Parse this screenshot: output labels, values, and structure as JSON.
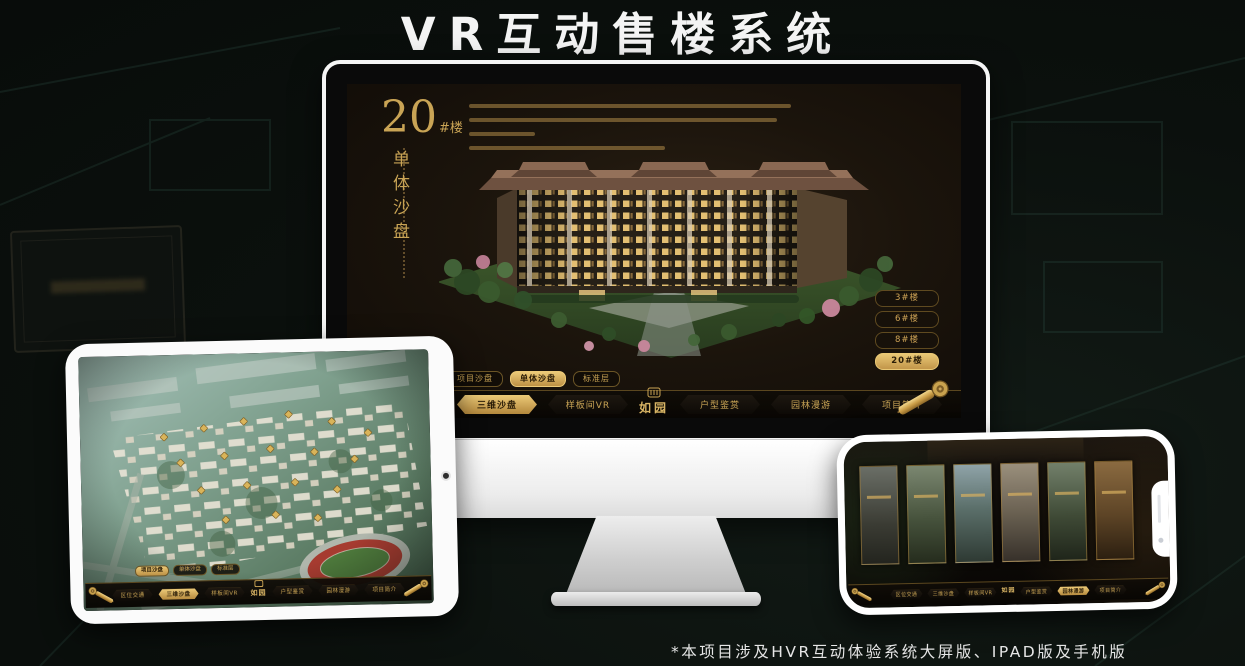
{
  "page": {
    "title": "VR互动售楼系统",
    "footnote": "*本项目涉及HVR互动体验系统大屏版、IPAD版及手机版"
  },
  "colors": {
    "gold": "#c9a455",
    "gold_bright": "#ecca78",
    "screen_bg": "#1b140c",
    "nav_bg": "#0d0a06",
    "canvas_bg": "#0b100d"
  },
  "monitor": {
    "building_no": "20",
    "building_no_suffix": "#楼",
    "building_subtitle": "单体沙盘",
    "floor_buttons": [
      {
        "label": "3#楼",
        "active": false
      },
      {
        "label": "6#楼",
        "active": false
      },
      {
        "label": "8#楼",
        "active": false
      },
      {
        "label": "20#楼",
        "active": true
      }
    ],
    "view_tabs": [
      {
        "label": "项目沙盘",
        "active": false
      },
      {
        "label": "单体沙盘",
        "active": true
      },
      {
        "label": "标准层",
        "active": false
      }
    ]
  },
  "tablet": {
    "view_tabs": [
      {
        "label": "项目沙盘",
        "active": true
      },
      {
        "label": "单体沙盘",
        "active": false
      },
      {
        "label": "标准层",
        "active": false
      }
    ],
    "scene": "aerial-masterplan-view"
  },
  "phone": {
    "gallery_panels": 6,
    "scene": "interior-gallery-view",
    "active_nav": "园林漫游"
  },
  "nav": {
    "logo": "如园",
    "monitor_active": "三维沙盘",
    "tablet_active": "三维沙盘",
    "items": [
      {
        "label": "区位交通"
      },
      {
        "label": "三维沙盘"
      },
      {
        "label": "样板间VR"
      },
      {
        "label": "户型鉴赏"
      },
      {
        "label": "园林漫游"
      },
      {
        "label": "项目简介"
      }
    ]
  }
}
